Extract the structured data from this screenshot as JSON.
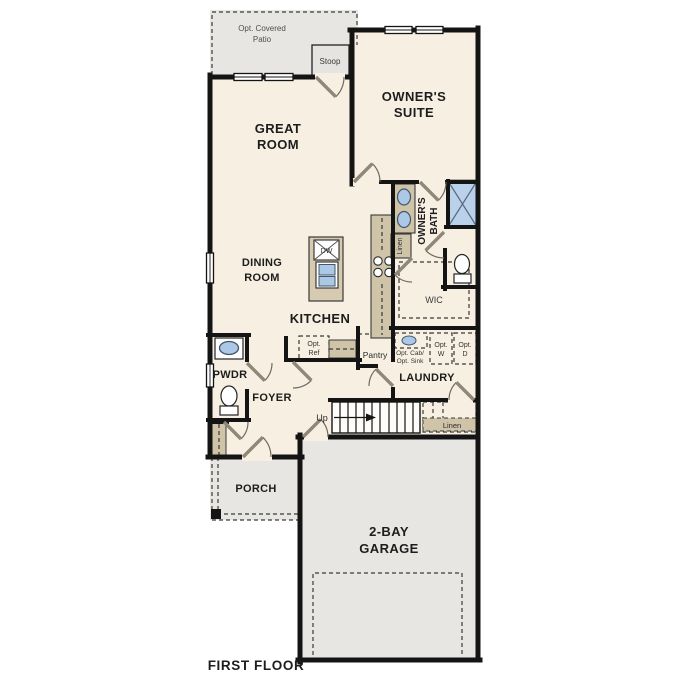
{
  "plan": {
    "title": "FIRST FLOOR",
    "rooms": {
      "patio_line1": "Opt. Covered",
      "patio_line2": "Patio",
      "stoop": "Stoop",
      "owners_suite_line1": "OWNER'S",
      "owners_suite_line2": "SUITE",
      "great_room_line1": "GREAT",
      "great_room_line2": "ROOM",
      "dining_room_line1": "DINING",
      "dining_room_line2": "ROOM",
      "owners_bath_line1": "OWNER'S",
      "owners_bath_line2": "BATH",
      "wic": "WIC",
      "kitchen": "KITCHEN",
      "pantry": "Pantry",
      "pwdr": "PWDR",
      "foyer": "FOYER",
      "laundry": "LAUNDRY",
      "porch": "PORCH",
      "garage_line1": "2-BAY",
      "garage_line2": "GARAGE"
    },
    "features": {
      "dishwasher": "DW",
      "opt_ref_line1": "Opt.",
      "opt_ref_line2": "Ref",
      "opt_cab": "Opt. Cab/",
      "opt_sink": "Opt. Sink",
      "opt_w_line1": "Opt.",
      "opt_w_line2": "W",
      "opt_d_line1": "Opt.",
      "opt_d_line2": "D",
      "linen_bath": "Linen",
      "linen_hall": "Linen",
      "up": "Up"
    },
    "colors": {
      "wall": "#141414",
      "floor": "#f7f0e2",
      "concrete": "#e7e6e3",
      "cabinet": "#cfc3a8",
      "fixture_blue": "#abc8e6",
      "appliance_gray": "#dde3e9"
    }
  }
}
